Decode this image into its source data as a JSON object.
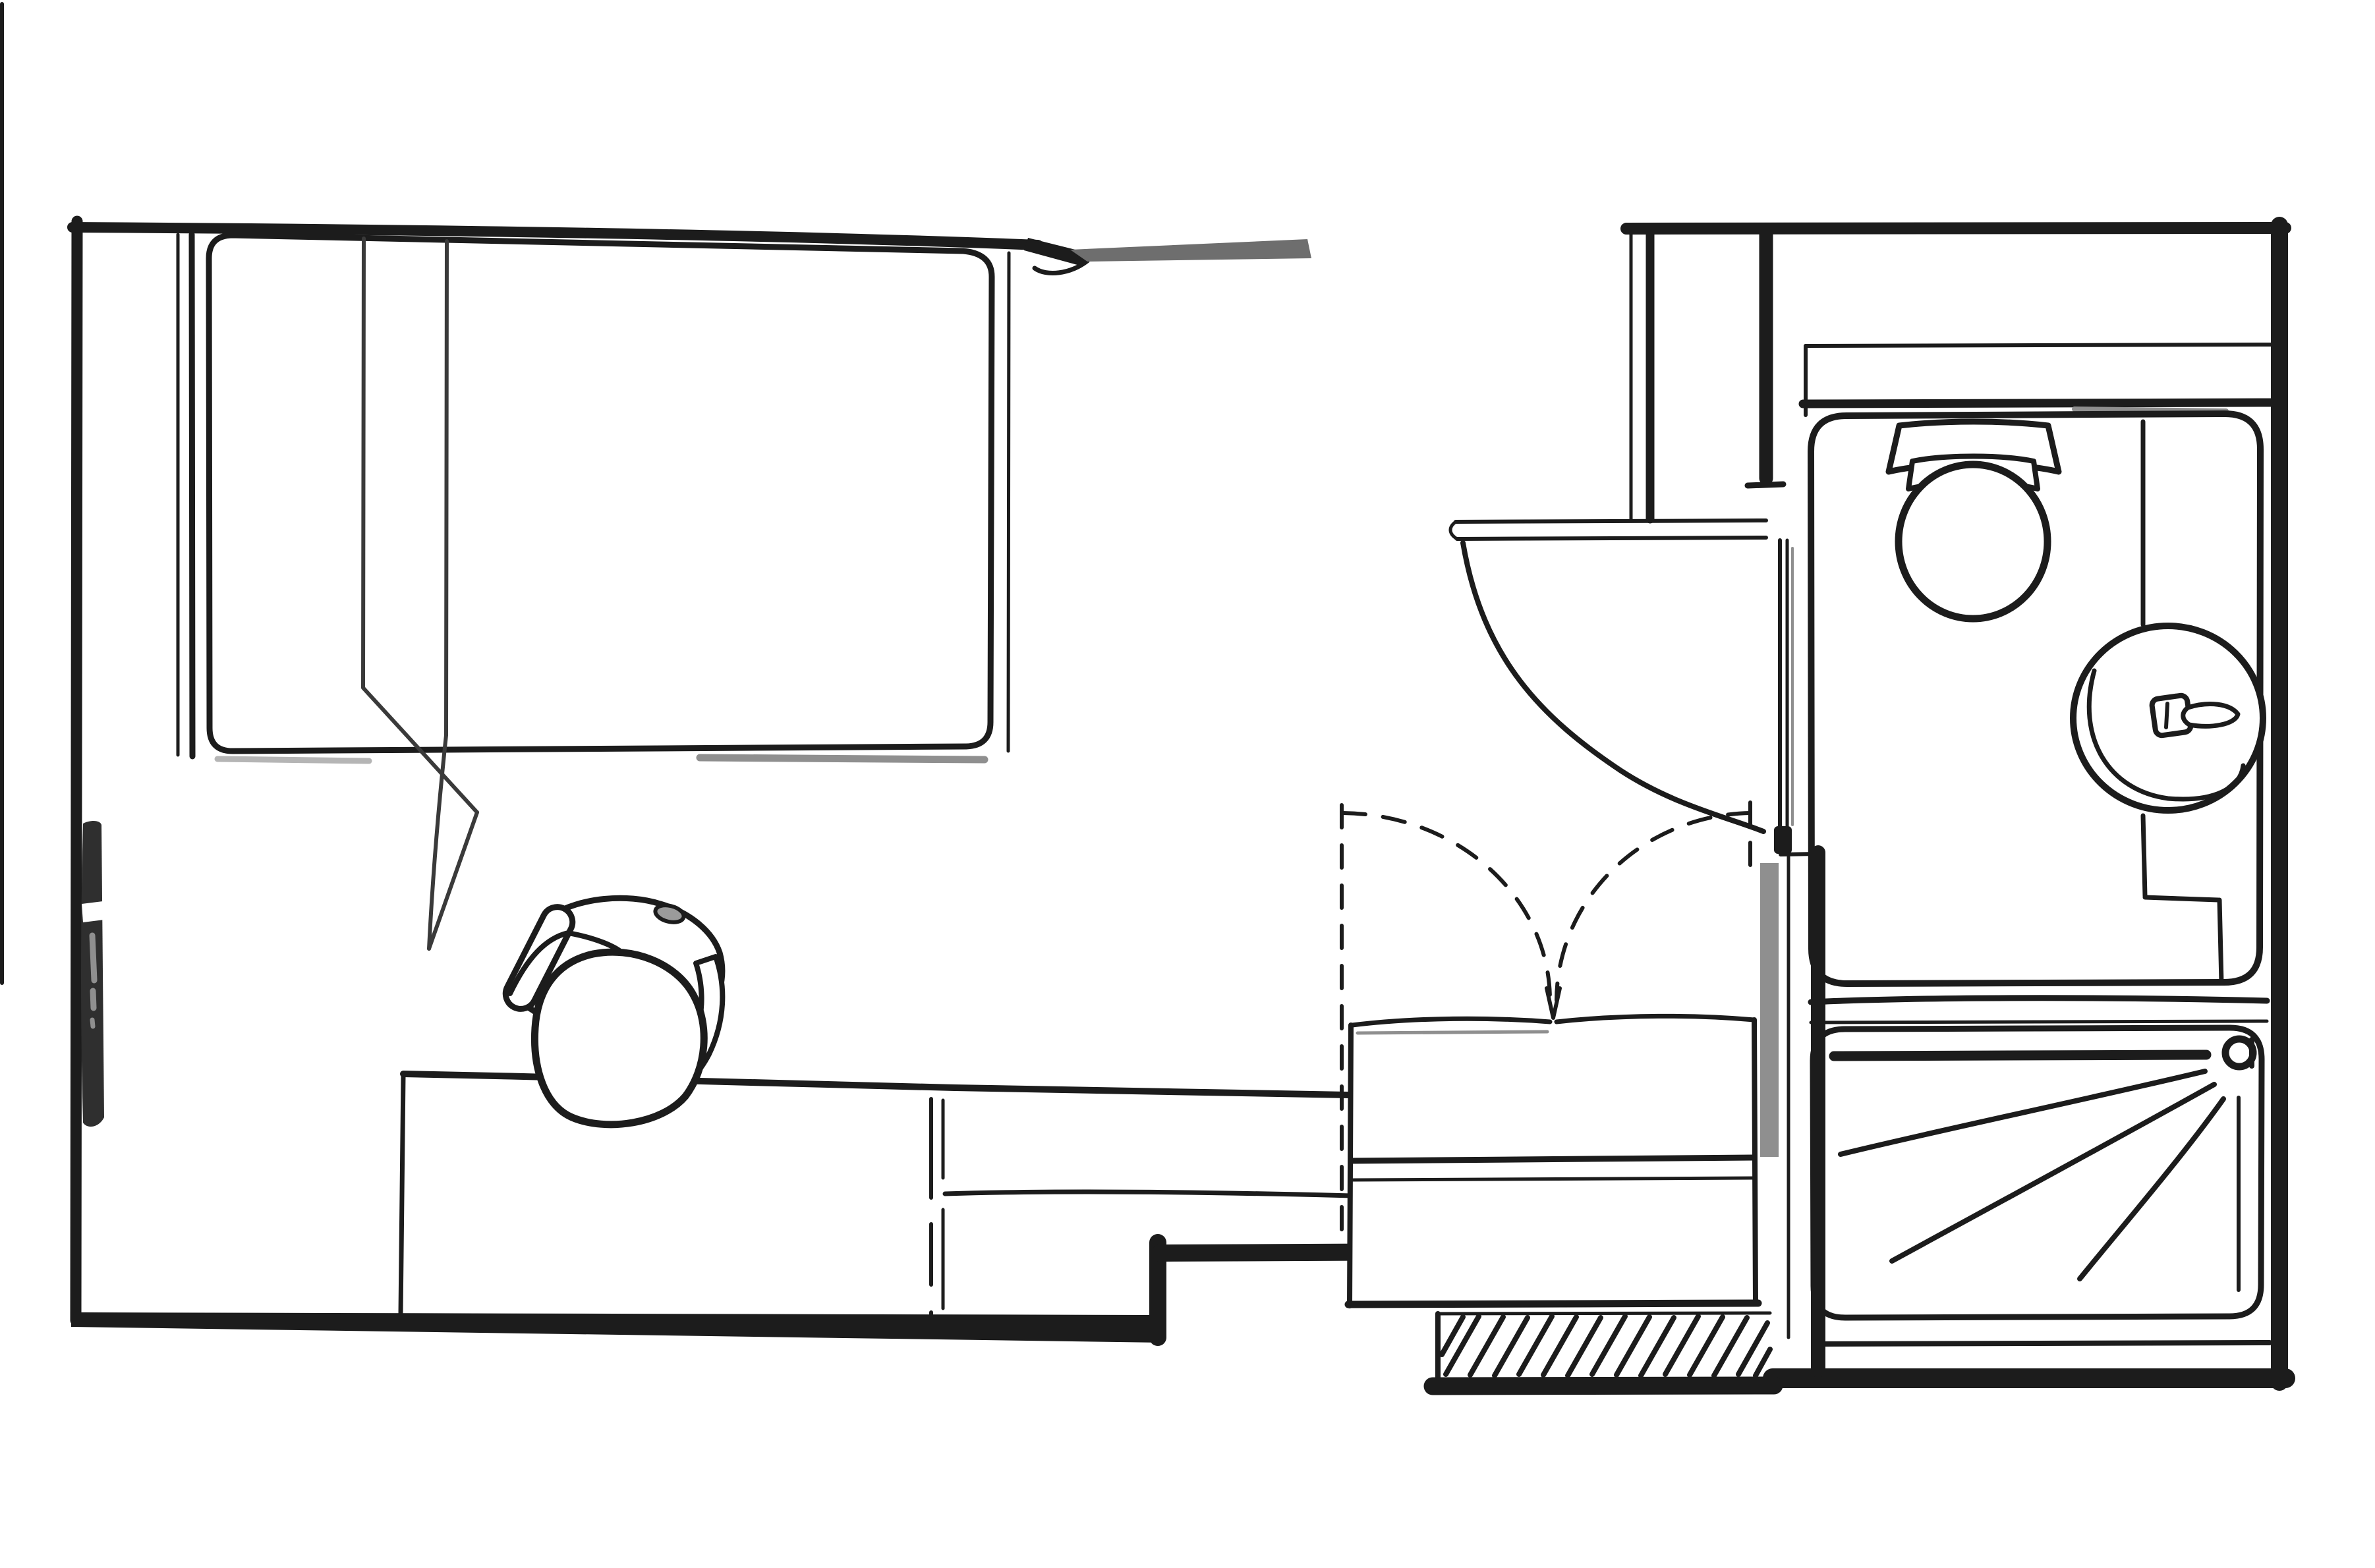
{
  "title": "Hand-drawn black and white floor plan of a studio room with en-suite bathroom, top-down view",
  "colors": {
    "ink": "#1c1c1c",
    "soft_ink": "#3a3a3a",
    "gray_bar": "#6e6e6e",
    "shadow_gray": "#8f8f8f",
    "light_gray": "#b5b5b5",
    "paper": "#ffffff",
    "radiator": "#2f2f2f",
    "chair_pad_gray": "#9b9b9b"
  },
  "rooms": [
    {
      "name": "main-room",
      "label": "Studio room with bed, desk and wardrobe"
    },
    {
      "name": "entry-hall",
      "label": "Entry area with door swing and hatched threshold"
    },
    {
      "name": "bathroom",
      "label": "En-suite bathroom with toilet, basin and shower"
    }
  ],
  "elements": [
    {
      "name": "left-wall",
      "label": "Exterior wall, left side"
    },
    {
      "name": "top-wall",
      "label": "Exterior wall, top of studio room"
    },
    {
      "name": "top-opening-bar",
      "label": "Gray opening / lintel segment in top wall"
    },
    {
      "name": "bathroom-top-wall",
      "label": "Exterior wall above bathroom"
    },
    {
      "name": "right-wall",
      "label": "Exterior wall, right side"
    },
    {
      "name": "bottom-wall",
      "label": "Exterior wall, bottom, with step and jamb"
    },
    {
      "name": "threshold-hatch",
      "label": "Hatched entry threshold block"
    },
    {
      "name": "bed",
      "label": "Single bed with folded-back blanket corner"
    },
    {
      "name": "radiator",
      "label": "Radiator on left wall"
    },
    {
      "name": "desk",
      "label": "Desk along bottom wall"
    },
    {
      "name": "desk-counter",
      "label": "Counter extension to the right of the desk"
    },
    {
      "name": "office-chair",
      "label": "Office chair with seated figure, viewed from above"
    },
    {
      "name": "wardrobe-doors",
      "label": "Wardrobe with dashed double-door swing arcs"
    },
    {
      "name": "chest-of-drawers",
      "label": "Low drawer unit under the wardrobe"
    },
    {
      "name": "room-door",
      "label": "Interior door leaf with quarter-circle swing arc"
    },
    {
      "name": "partition-walls",
      "label": "Interior partition wall stubs around entry"
    },
    {
      "name": "duct-shelf",
      "label": "Service duct / ledge band behind toilet"
    },
    {
      "name": "toilet",
      "label": "Toilet with cistern, top view"
    },
    {
      "name": "wash-basin",
      "label": "Round wash basin with tap"
    },
    {
      "name": "shower",
      "label": "Shower tray with drain and spray lines"
    }
  ],
  "counts": {
    "shower_spray_lines": 3,
    "hatch_strokes": 15,
    "drawer_rows": 2
  }
}
